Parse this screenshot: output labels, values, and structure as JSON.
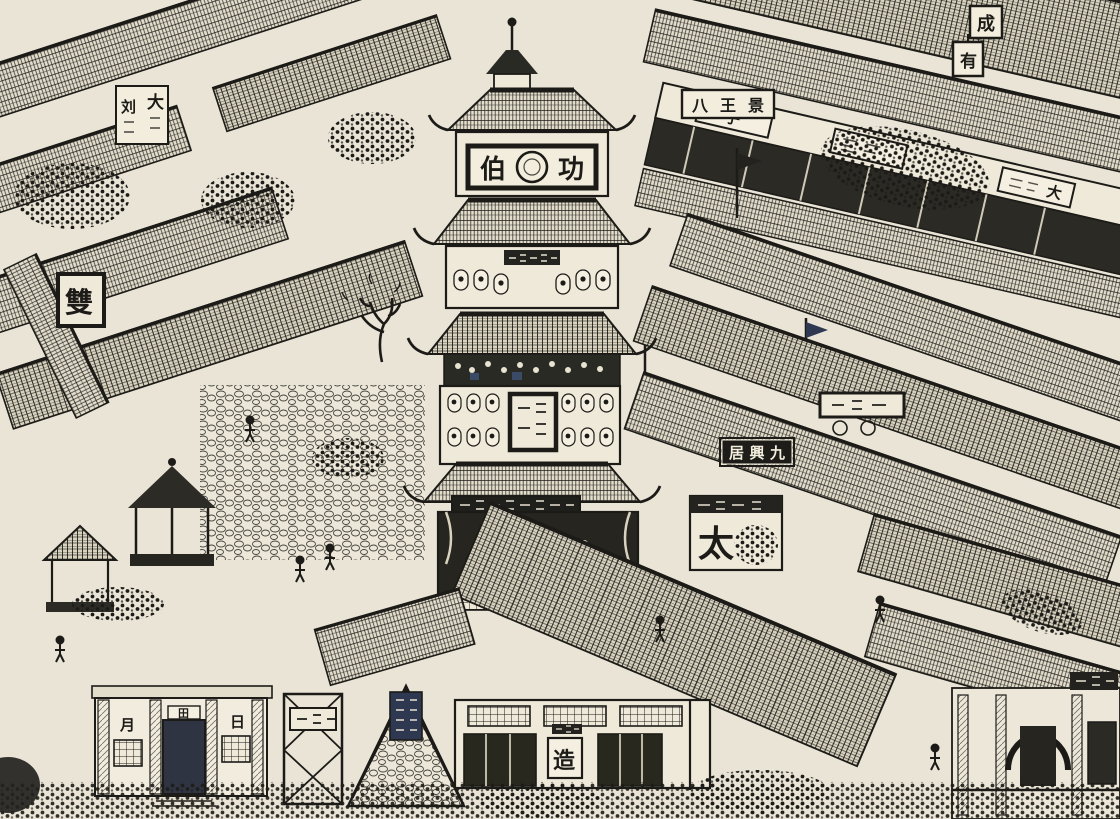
{
  "artwork": {
    "kind": "ink panorama illustration",
    "subject": "bird's-eye view of an old Chinese market district with a central multi-storey pagoda tower, tiled rooftops on diagonal streets, shop signs and crowds",
    "palette": {
      "paper": "#e9e4d6",
      "ink": "#1c1b17",
      "blue_ink": "#2e3850",
      "highlight": "#f2eddd"
    }
  },
  "signs": {
    "pagoda_plaque": {
      "left": "伯",
      "right": "功"
    },
    "banner_top_right": "八王景",
    "shop_sign_top_left": {
      "right_col": "大",
      "left_col": "刘"
    },
    "black_shop_sign": "居興九",
    "stall_banner": "太",
    "framed_sign_left": "雙",
    "corner_sign": "成",
    "lantern_sign": "有",
    "facade_chars": {
      "left": "月",
      "center": "田",
      "right": "日"
    },
    "shop_panel": "造",
    "beam_panel_a": "子",
    "beam_panel_b": "大"
  }
}
